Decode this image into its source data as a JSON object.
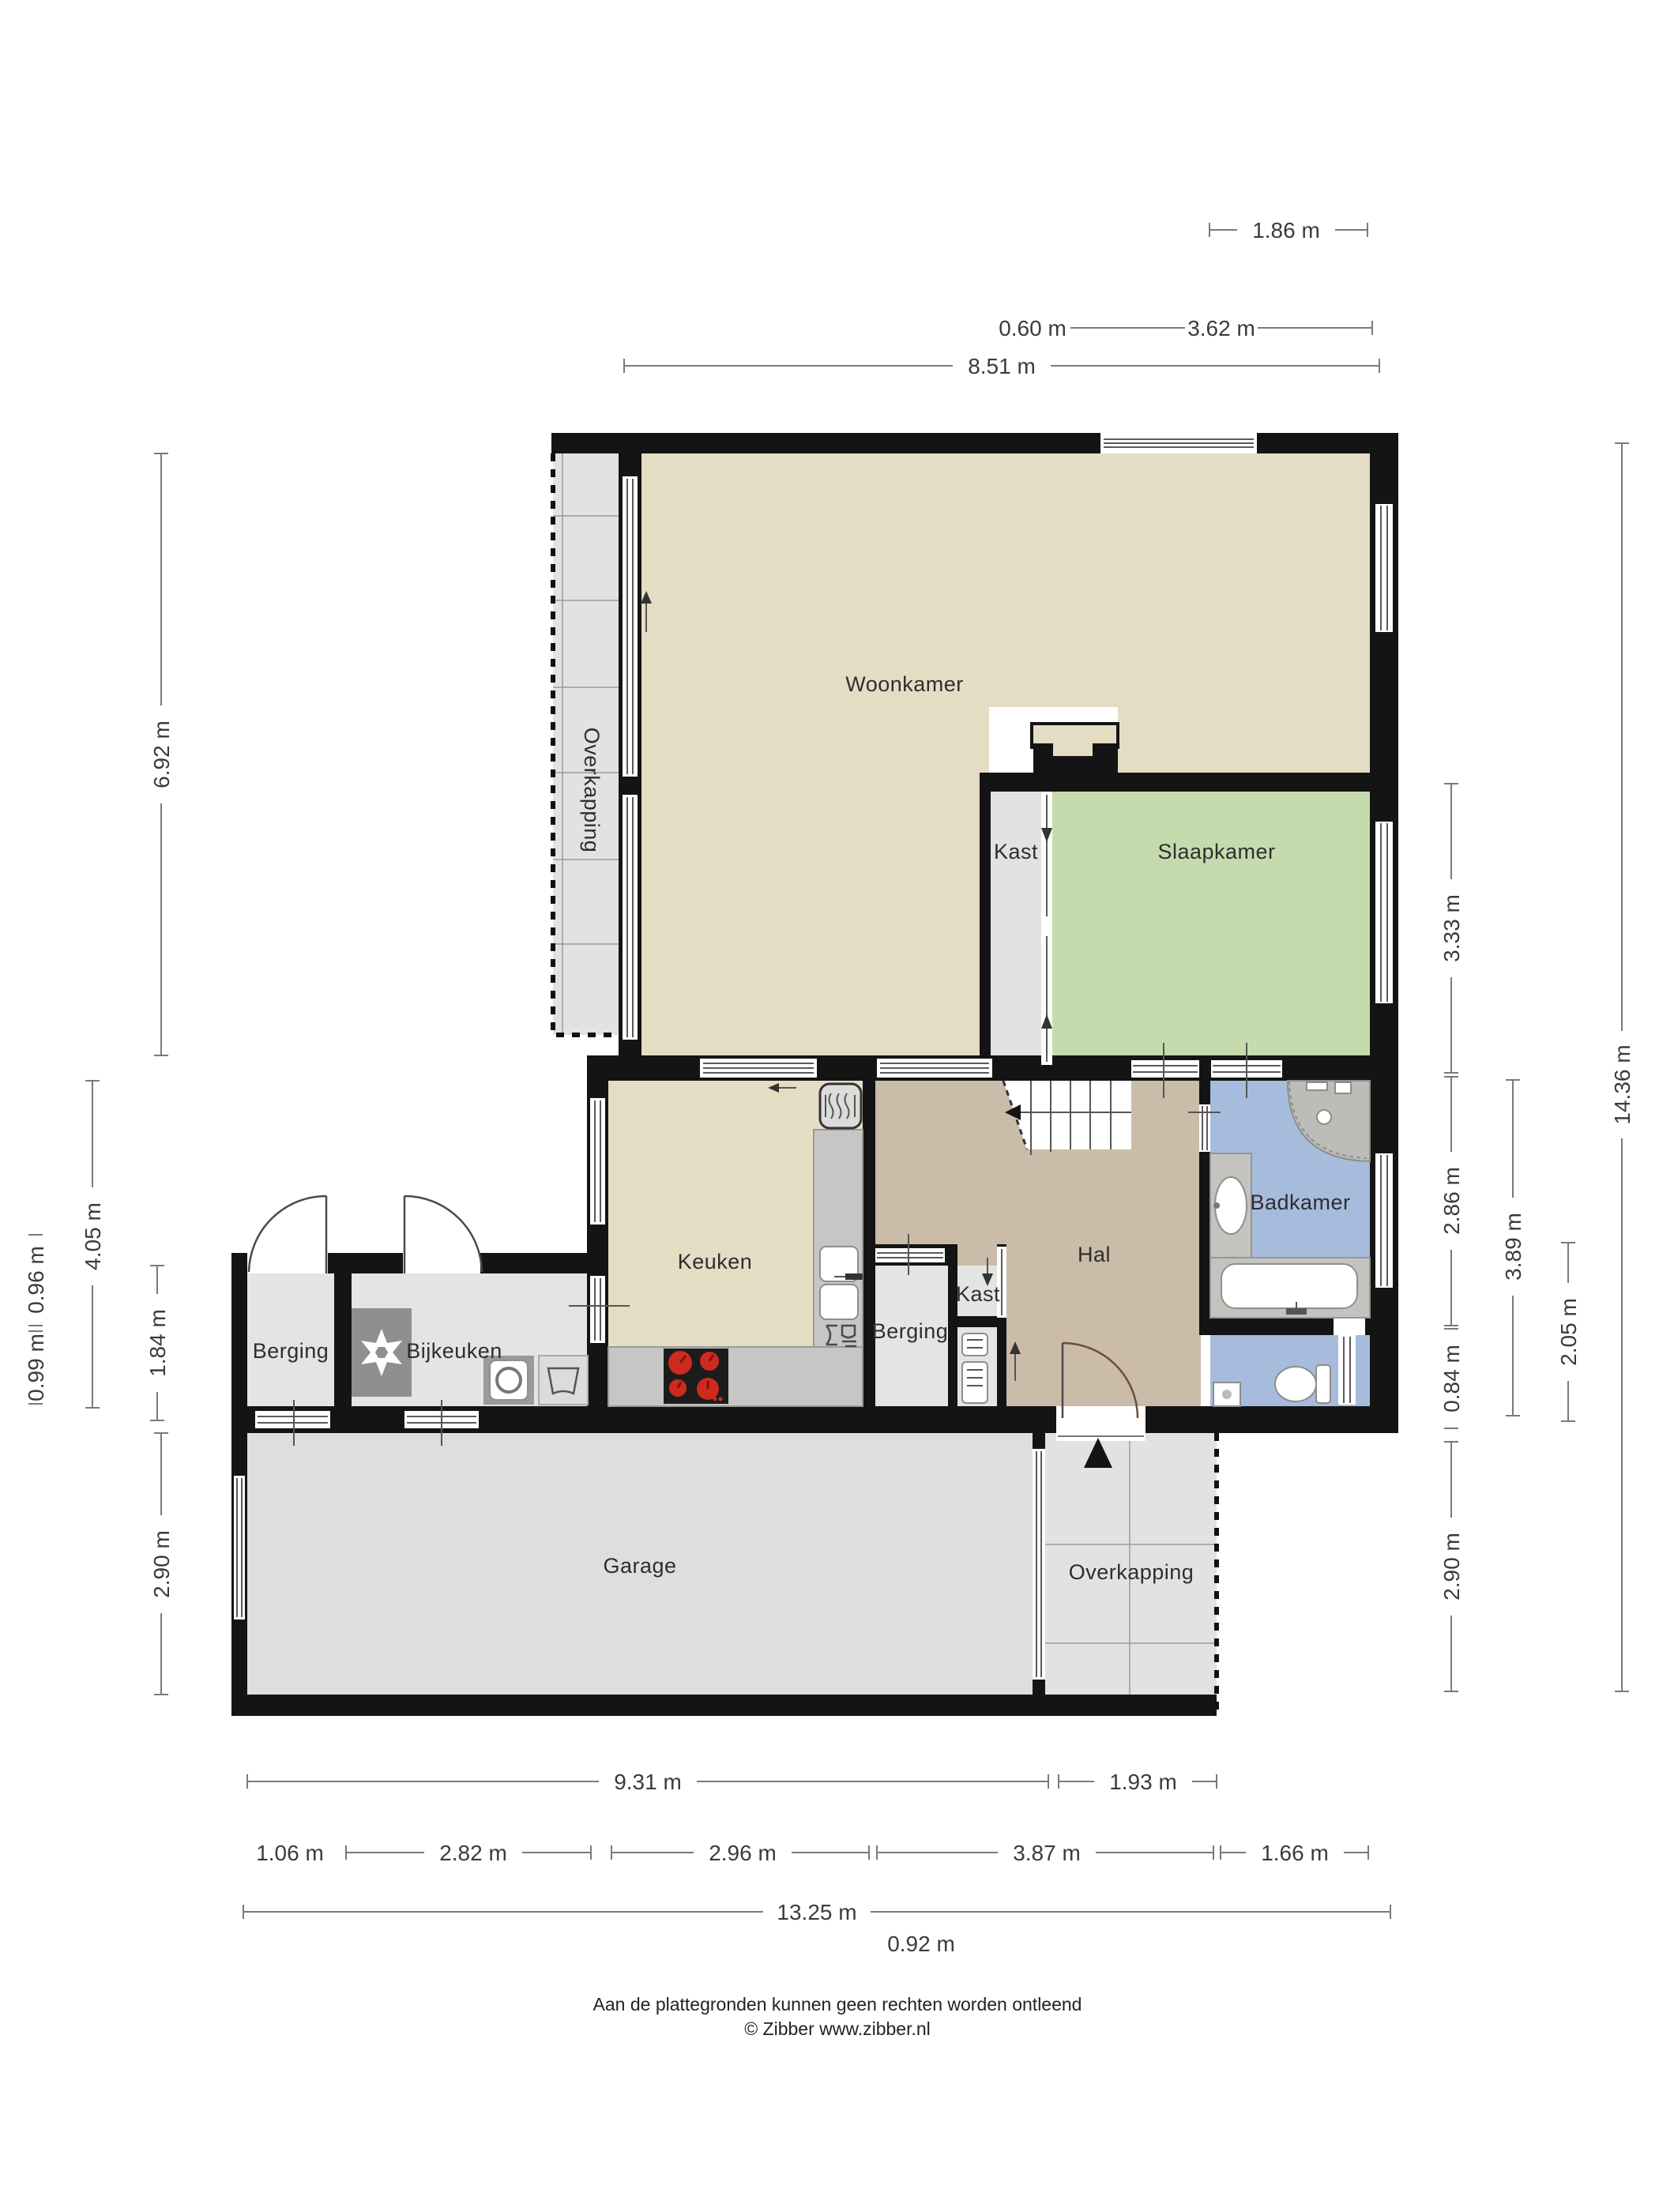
{
  "plan": {
    "type": "floor-plan",
    "palette": {
      "wall": "#141414",
      "woonkamer": "#e4ddc4",
      "keuken": "#e4ddc4",
      "slaapkamer": "#c5dbae",
      "badkamer": "#a7bcdc",
      "hal": "#cbbba9",
      "utility_room": "#e4e4e4",
      "garage": "#dedede",
      "counter": "#c6c6c4",
      "appliance_dark": "#8f8f8f",
      "cooktop": "#1c1c1c",
      "burner_red": "#cf2a20",
      "dim_line": "#7a7a7a",
      "dim_text": "#3b3b3b"
    }
  },
  "rooms": {
    "woonkamer": "Woonkamer",
    "slaapkamer": "Slaapkamer",
    "kast_boven": "Kast",
    "kast_midden": "Kast",
    "keuken": "Keuken",
    "hal": "Hal",
    "badkamer": "Badkamer",
    "berging_links": "Berging",
    "berging_midden": "Berging",
    "bijkeuken": "Bijkeuken",
    "garage": "Garage",
    "overkapping_zijde": "Overkapping",
    "overkapping_onder": "Overkapping"
  },
  "dims": {
    "top": [
      "1.86 m",
      "0.60 m",
      "3.62 m",
      "8.51 m"
    ],
    "left": [
      "6.92 m",
      "4.05 m",
      "0.96 m",
      "0.99 m",
      "1.84 m",
      "2.90 m"
    ],
    "right": [
      "3.33 m",
      "2.86 m",
      "0.84 m",
      "2.90 m",
      "3.89 m",
      "2.05 m",
      "14.36 m"
    ],
    "bottom": [
      "9.31 m",
      "1.93 m",
      "1.06 m",
      "2.82 m",
      "2.96 m",
      "3.87 m",
      "1.66 m",
      "13.25 m",
      "0.92 m"
    ]
  },
  "footer": {
    "disclaimer": "Aan de plattegronden kunnen geen rechten worden ontleend",
    "copyright": "© Zibber www.zibber.nl"
  }
}
